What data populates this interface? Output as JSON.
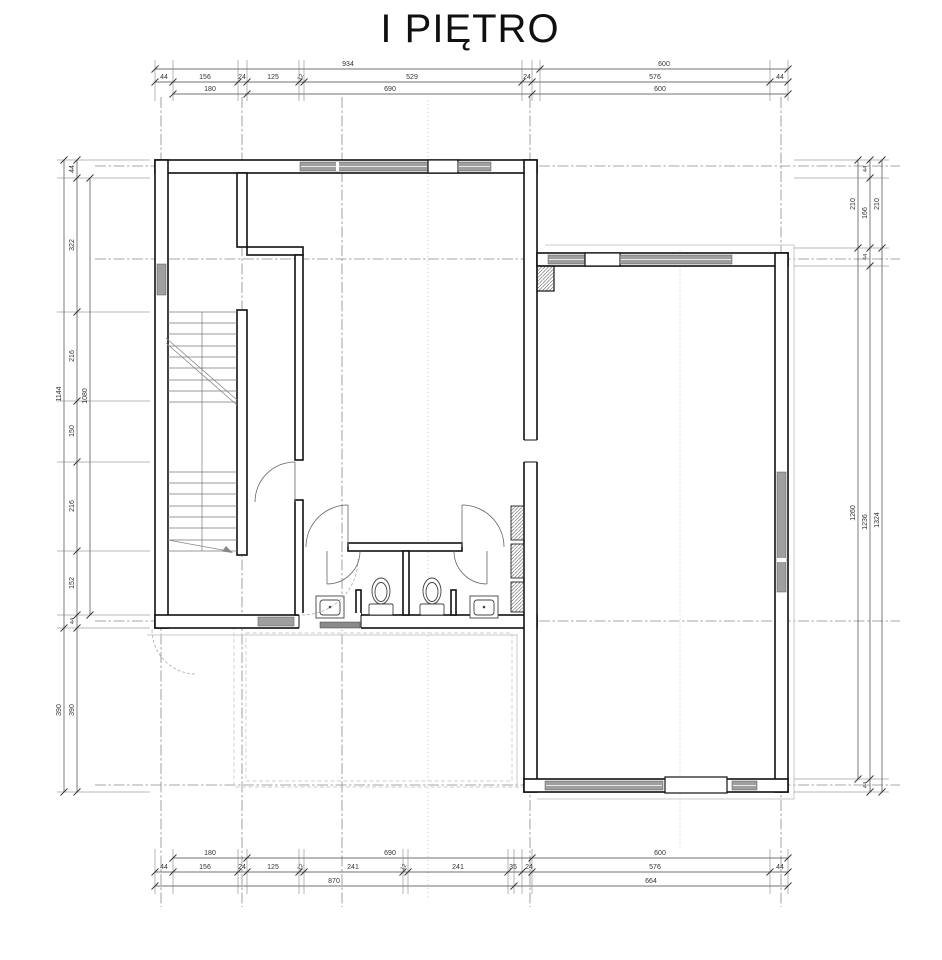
{
  "title": "I PIĘTRO",
  "dims": {
    "top_total": [
      "934",
      "600"
    ],
    "top_chain": [
      "44",
      "156",
      "24",
      "125",
      "12",
      "529",
      "24",
      "576",
      "44"
    ],
    "top_inner": [
      "180",
      "690",
      "600"
    ],
    "bottom_inner": [
      "180",
      "690",
      "600"
    ],
    "bottom_chain": [
      "44",
      "156",
      "24",
      "125",
      "12",
      "241",
      "12",
      "241",
      "35",
      "24",
      "576",
      "44"
    ],
    "bottom_total": [
      "870",
      "664"
    ],
    "left_total": [
      "1144",
      "390"
    ],
    "left_chain": [
      "44",
      "322",
      "216",
      "150",
      "216",
      "152",
      "44",
      "390"
    ],
    "left_inner": [
      "1080"
    ],
    "right_inner": [
      "210",
      "1260"
    ],
    "right_chain": [
      "44",
      "166",
      "44",
      "1236",
      "44"
    ],
    "right_total": [
      "210",
      "1324"
    ]
  }
}
